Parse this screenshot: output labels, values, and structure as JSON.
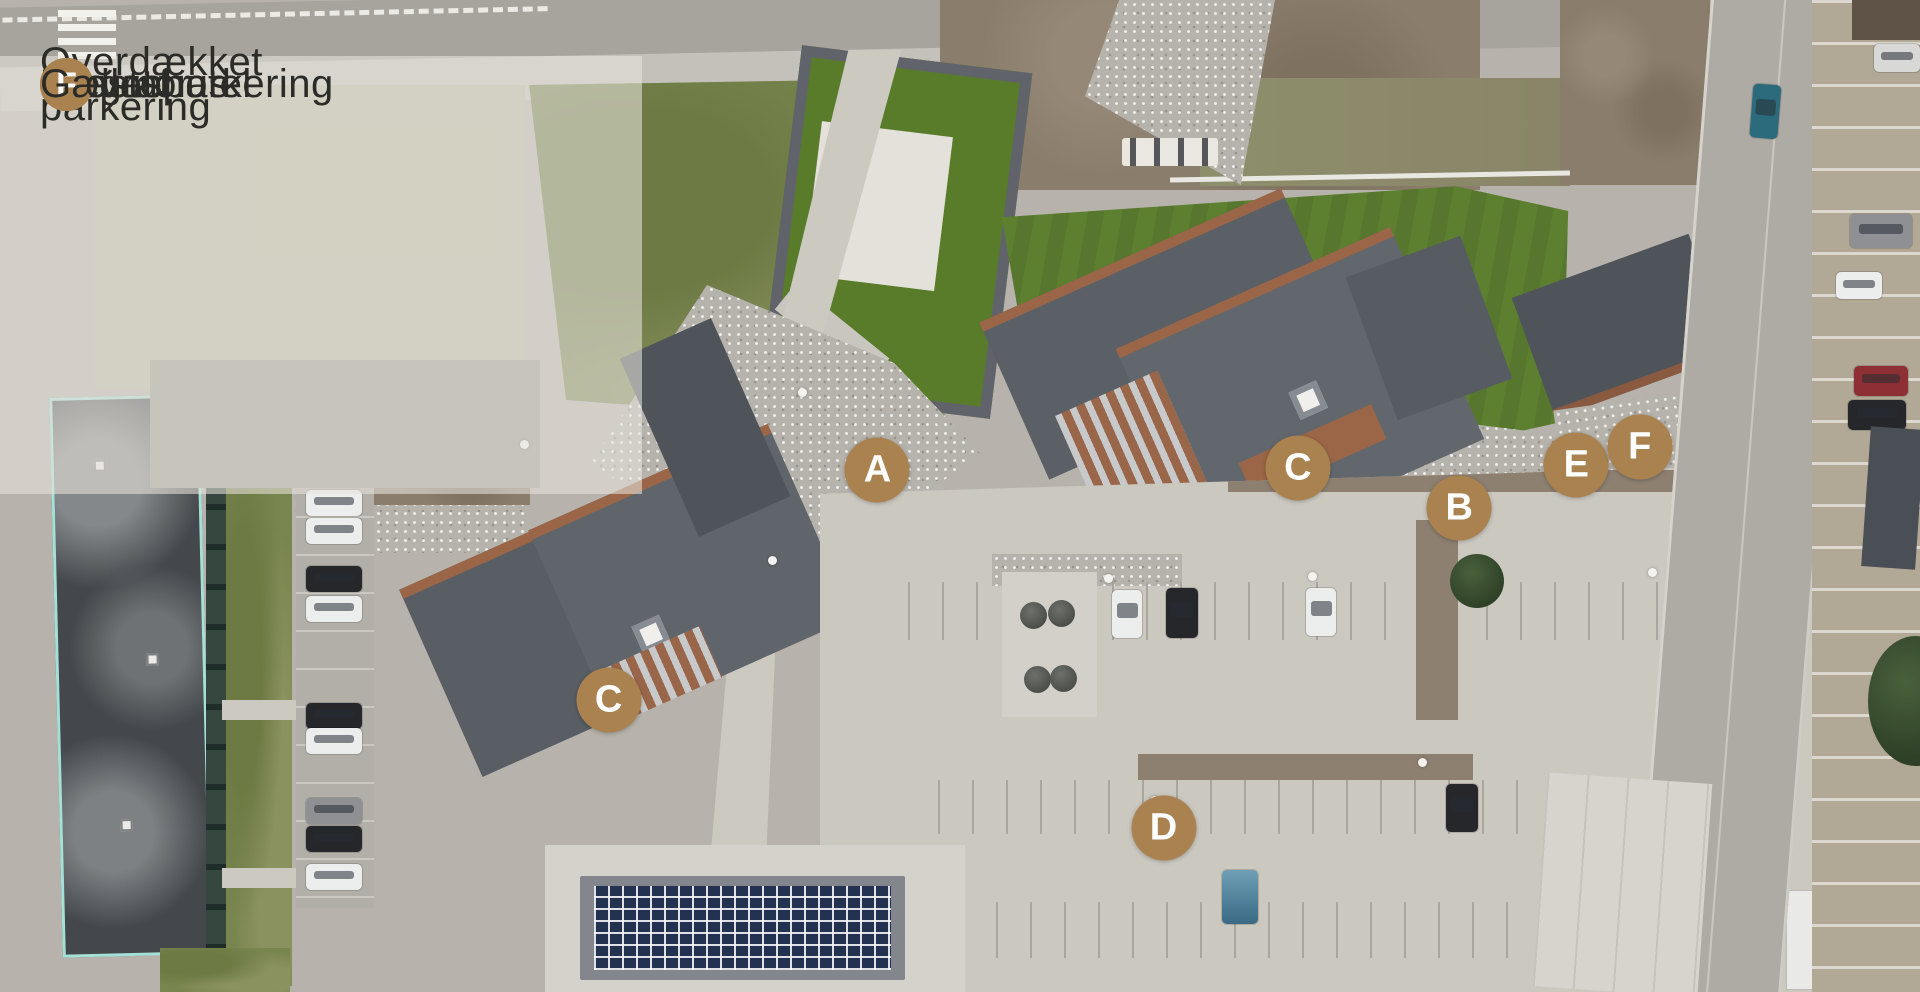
{
  "legend": {
    "items": [
      {
        "id": "A",
        "label": "Biograf"
      },
      {
        "id": "B",
        "label": "Overdækket parkering"
      },
      {
        "id": "C",
        "label": "Elevator"
      },
      {
        "id": "D",
        "label": "Gæsteparkering"
      },
      {
        "id": "E",
        "label": "Fælleshus"
      },
      {
        "id": "F",
        "label": "Gæstehotel"
      }
    ]
  },
  "map": {
    "markers": [
      {
        "letter": "A",
        "style": "left:45.7%;top:47.4%"
      },
      {
        "letter": "C",
        "style": "left:31.7%;top:70.6%"
      },
      {
        "letter": "C",
        "style": "left:67.6%;top:47.2%"
      },
      {
        "letter": "B",
        "style": "left:76.0%;top:51.2%"
      },
      {
        "letter": "E",
        "style": "left:82.1%;top:46.9%"
      },
      {
        "letter": "F",
        "style": "left:85.4%;top:45.1%"
      },
      {
        "letter": "D",
        "style": "left:60.6%;top:83.5%"
      }
    ]
  },
  "colors": {
    "marker_bg": "#a9824f",
    "marker_text": "#ffffff",
    "legend_text": "#2b2b28",
    "overlay": "rgba(231,228,220,0.58)",
    "roof_slate": "#5b6067",
    "roof_rust": "#9a6647",
    "lawn_green": "#5d8030",
    "scaffold_teal": "#a4e0d6"
  }
}
